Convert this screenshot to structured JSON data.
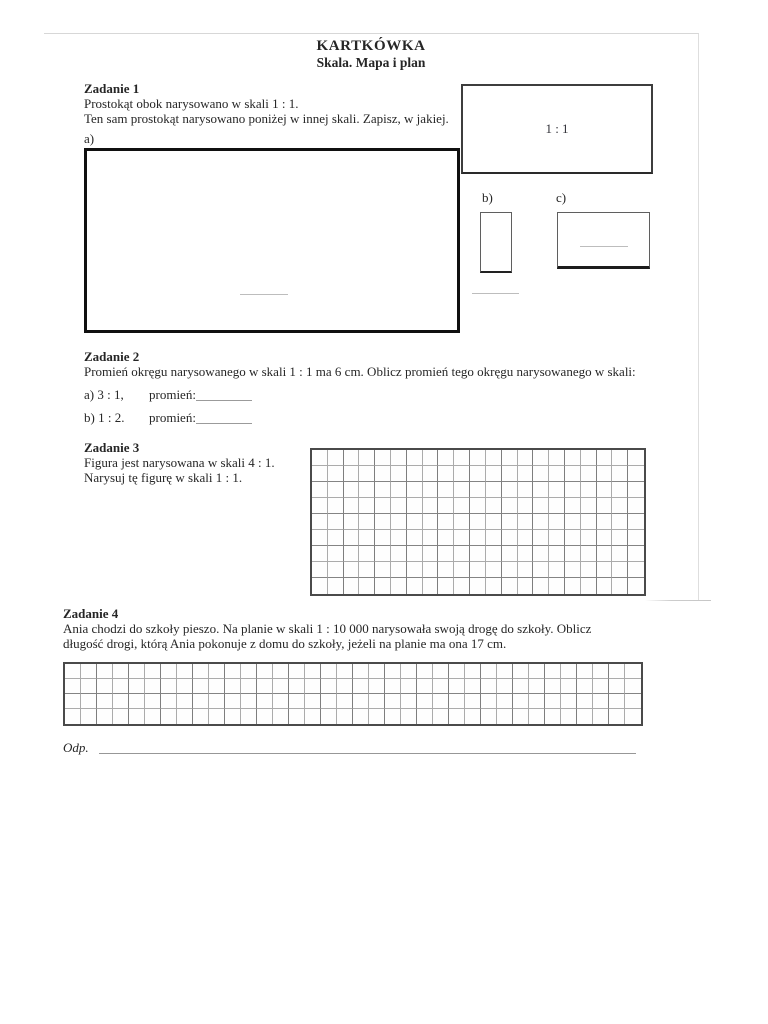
{
  "header": {
    "title": "KARTKÓWKA",
    "subtitle": "Skala. Mapa i plan"
  },
  "task1": {
    "heading": "Zadanie 1",
    "line1": "Prostokąt obok narysowano w skali 1 : 1.",
    "line2": "Ten sam prostokąt narysowano poniżej w innej skali. Zapisz, w jakiej.",
    "label_a": "a)",
    "label_b": "b)",
    "label_c": "c)",
    "reference_scale": "1 : 1"
  },
  "task2": {
    "heading": "Zadanie 2",
    "intro": "Promień okręgu narysowanego w skali 1 : 1 ma 6 cm. Oblicz promień tego okręgu narysowanego w skali:",
    "items": [
      {
        "label": "a) 3 : 1,",
        "field_label": "promień:"
      },
      {
        "label": "b) 1 : 2.",
        "field_label": "promień:"
      }
    ]
  },
  "task3": {
    "heading": "Zadanie 3",
    "line1": "Figura jest narysowana w skali 4 : 1.",
    "line2": "Narysuj tę figurę w skali 1 : 1.",
    "grid": {
      "rows": 9,
      "cols": 21
    }
  },
  "task4": {
    "heading": "Zadanie 4",
    "line1": "Ania chodzi do szkoły pieszo. Na planie w skali 1 : 10 000 narysowała swoją drogę do szkoły. Oblicz",
    "line2": "długość drogi, którą Ania pokonuje z domu do szkoły, jeżeli na planie ma ona 17 cm.",
    "answer_label": "Odp.",
    "grid": {
      "rows": 4,
      "cols": 36
    }
  }
}
